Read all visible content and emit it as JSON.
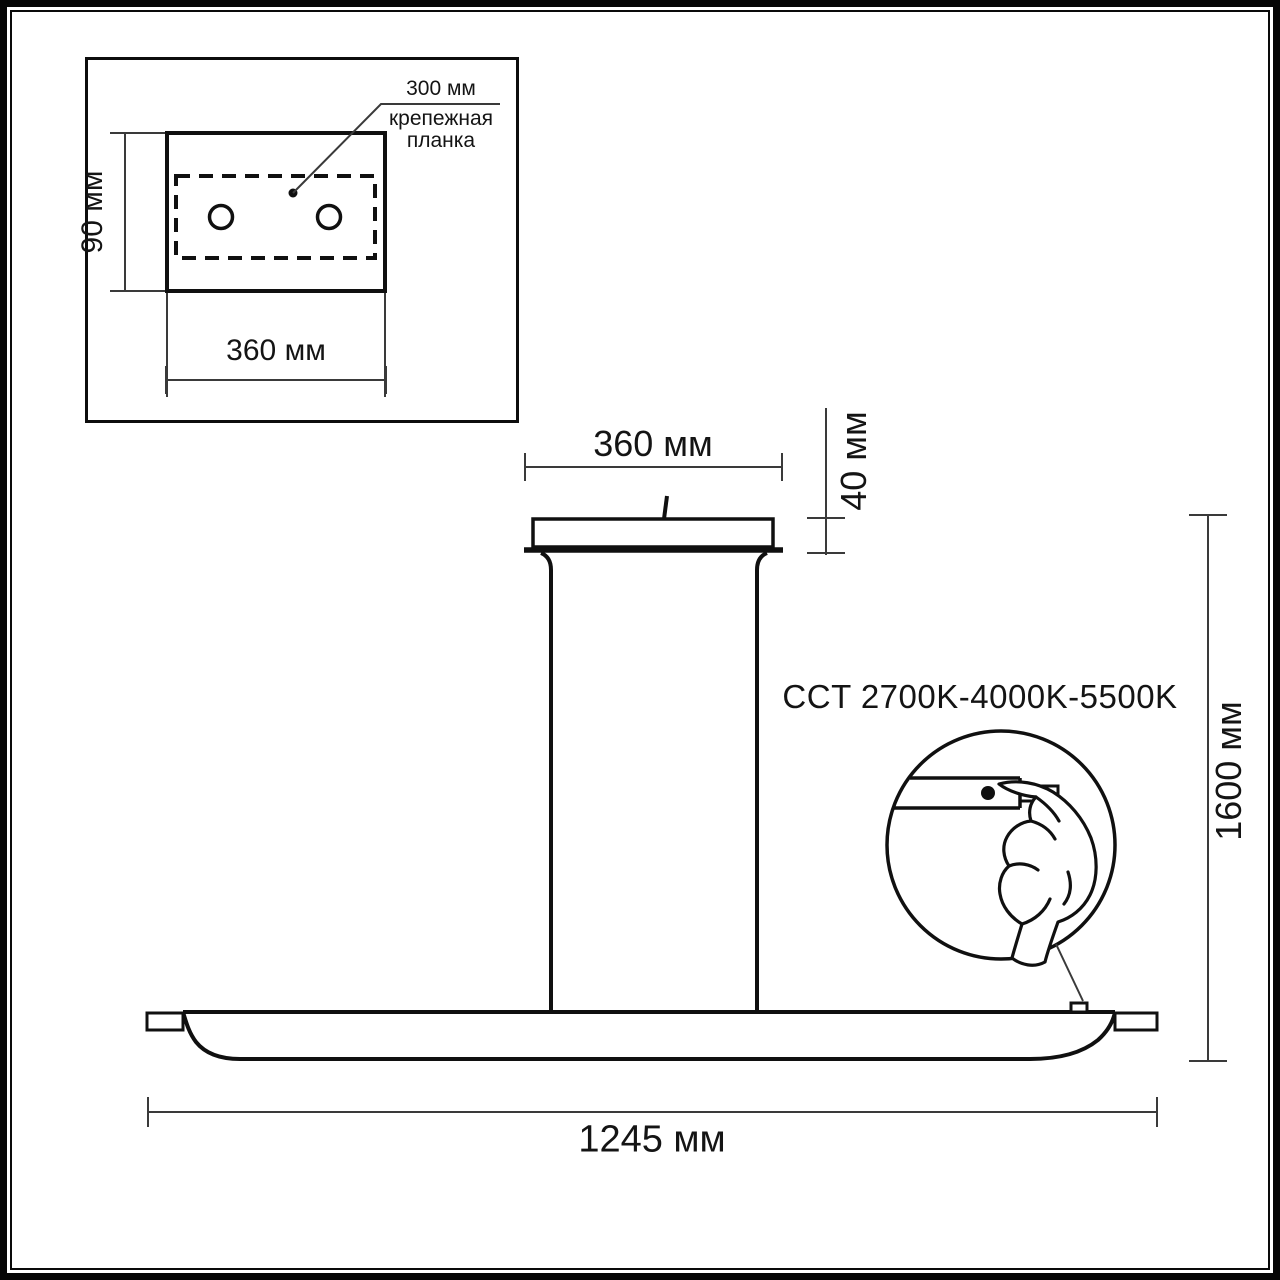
{
  "drawing_title": "pendant-lamp-dimension-drawing",
  "inset": {
    "height_label": "90 мм",
    "width_label": "360 мм",
    "plate_offset_label": "300 мм",
    "plate_name_line1": "крепежная",
    "plate_name_line2": "планка",
    "screw_hole_count": 2
  },
  "main": {
    "canopy_width_label": "360 мм",
    "canopy_height_label": "40 мм",
    "total_height_label": "1600 мм",
    "bar_length_label": "1245 мм",
    "cct_label": "CCT 2700K-4000K-5500K"
  },
  "icons": {
    "detail_circle": "cct-touch-control-detail",
    "hand": "pointing-hand-icon",
    "button": "touch-button-dot"
  },
  "colors": {
    "object_line": "#111111",
    "dimension_line": "#3a3a3a",
    "background": "#ffffff"
  }
}
